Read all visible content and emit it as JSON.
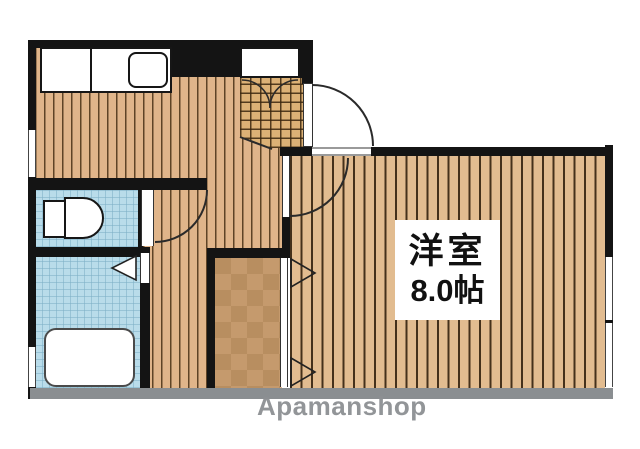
{
  "room_label": {
    "name": "洋室",
    "size": "8.0帖"
  },
  "watermark": "Apamanshop",
  "colors": {
    "wall": "#141414",
    "bottom_wall_gray": "#8a8e91",
    "floor_wood": "#e0b58a",
    "room_wood": "#e2bc90",
    "tile_blue": "#b9dcea",
    "genkan_tile": "#dcb176",
    "closet_light": "#c59a6d",
    "closet_dark": "#b88e60",
    "watermark_gray": "#8d9093"
  }
}
